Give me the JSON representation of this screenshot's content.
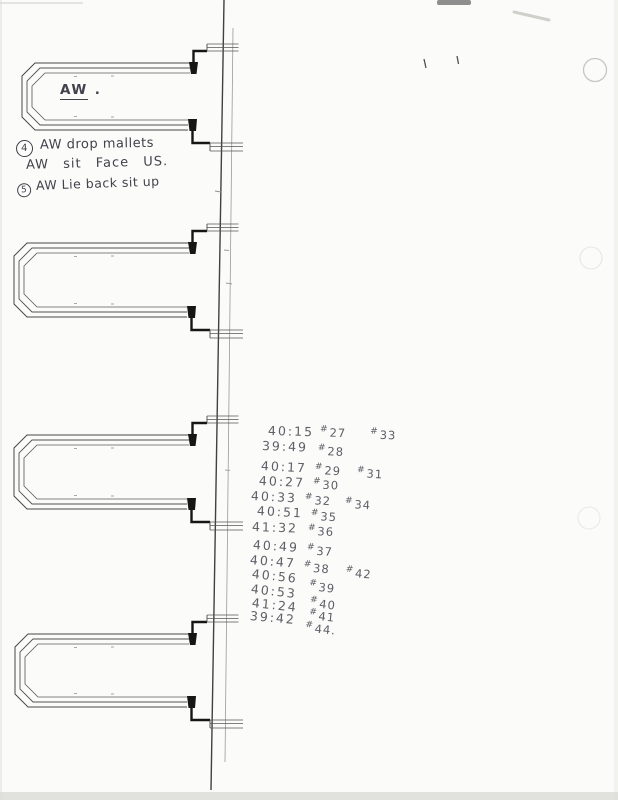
{
  "palette": {
    "paper": "#fbfbf9",
    "ink": "#42424d",
    "pencil": "#51515c",
    "line": "#4a4a4a"
  },
  "drawing": {
    "loop_label": "AW",
    "loop_label_dot": ".",
    "loop_count": 4
  },
  "notes": {
    "line1_badge": "4",
    "line1_text": "AW drop mallets",
    "line2_text": "AW sit Face US.",
    "line3_badge": "5",
    "line3_text": "AW Lie back sit up"
  },
  "time_list": {
    "rows": [
      {
        "time": "40:15",
        "marks": [
          "#27",
          "#33"
        ]
      },
      {
        "time": "39:49",
        "marks": [
          "#28"
        ]
      },
      {
        "time": "40:17",
        "marks": [
          "#29",
          "#31"
        ]
      },
      {
        "time": "40:27",
        "marks": [
          "#30"
        ]
      },
      {
        "time": "40:33",
        "marks": [
          "#32",
          "#34"
        ]
      },
      {
        "time": "40:51",
        "marks": [
          "#35"
        ]
      },
      {
        "time": "41:32",
        "marks": [
          "#36"
        ]
      },
      {
        "time": "40:49",
        "marks": [
          "#37"
        ]
      },
      {
        "time": "40:47",
        "marks": [
          "#38",
          "#42"
        ]
      },
      {
        "time": "40:56",
        "marks": [
          "#39"
        ]
      },
      {
        "time": "40:53",
        "marks": [
          "#40"
        ]
      },
      {
        "time": "41:24",
        "marks": [
          "#41"
        ]
      },
      {
        "time": "39:42",
        "marks": [
          "#44."
        ]
      }
    ]
  }
}
